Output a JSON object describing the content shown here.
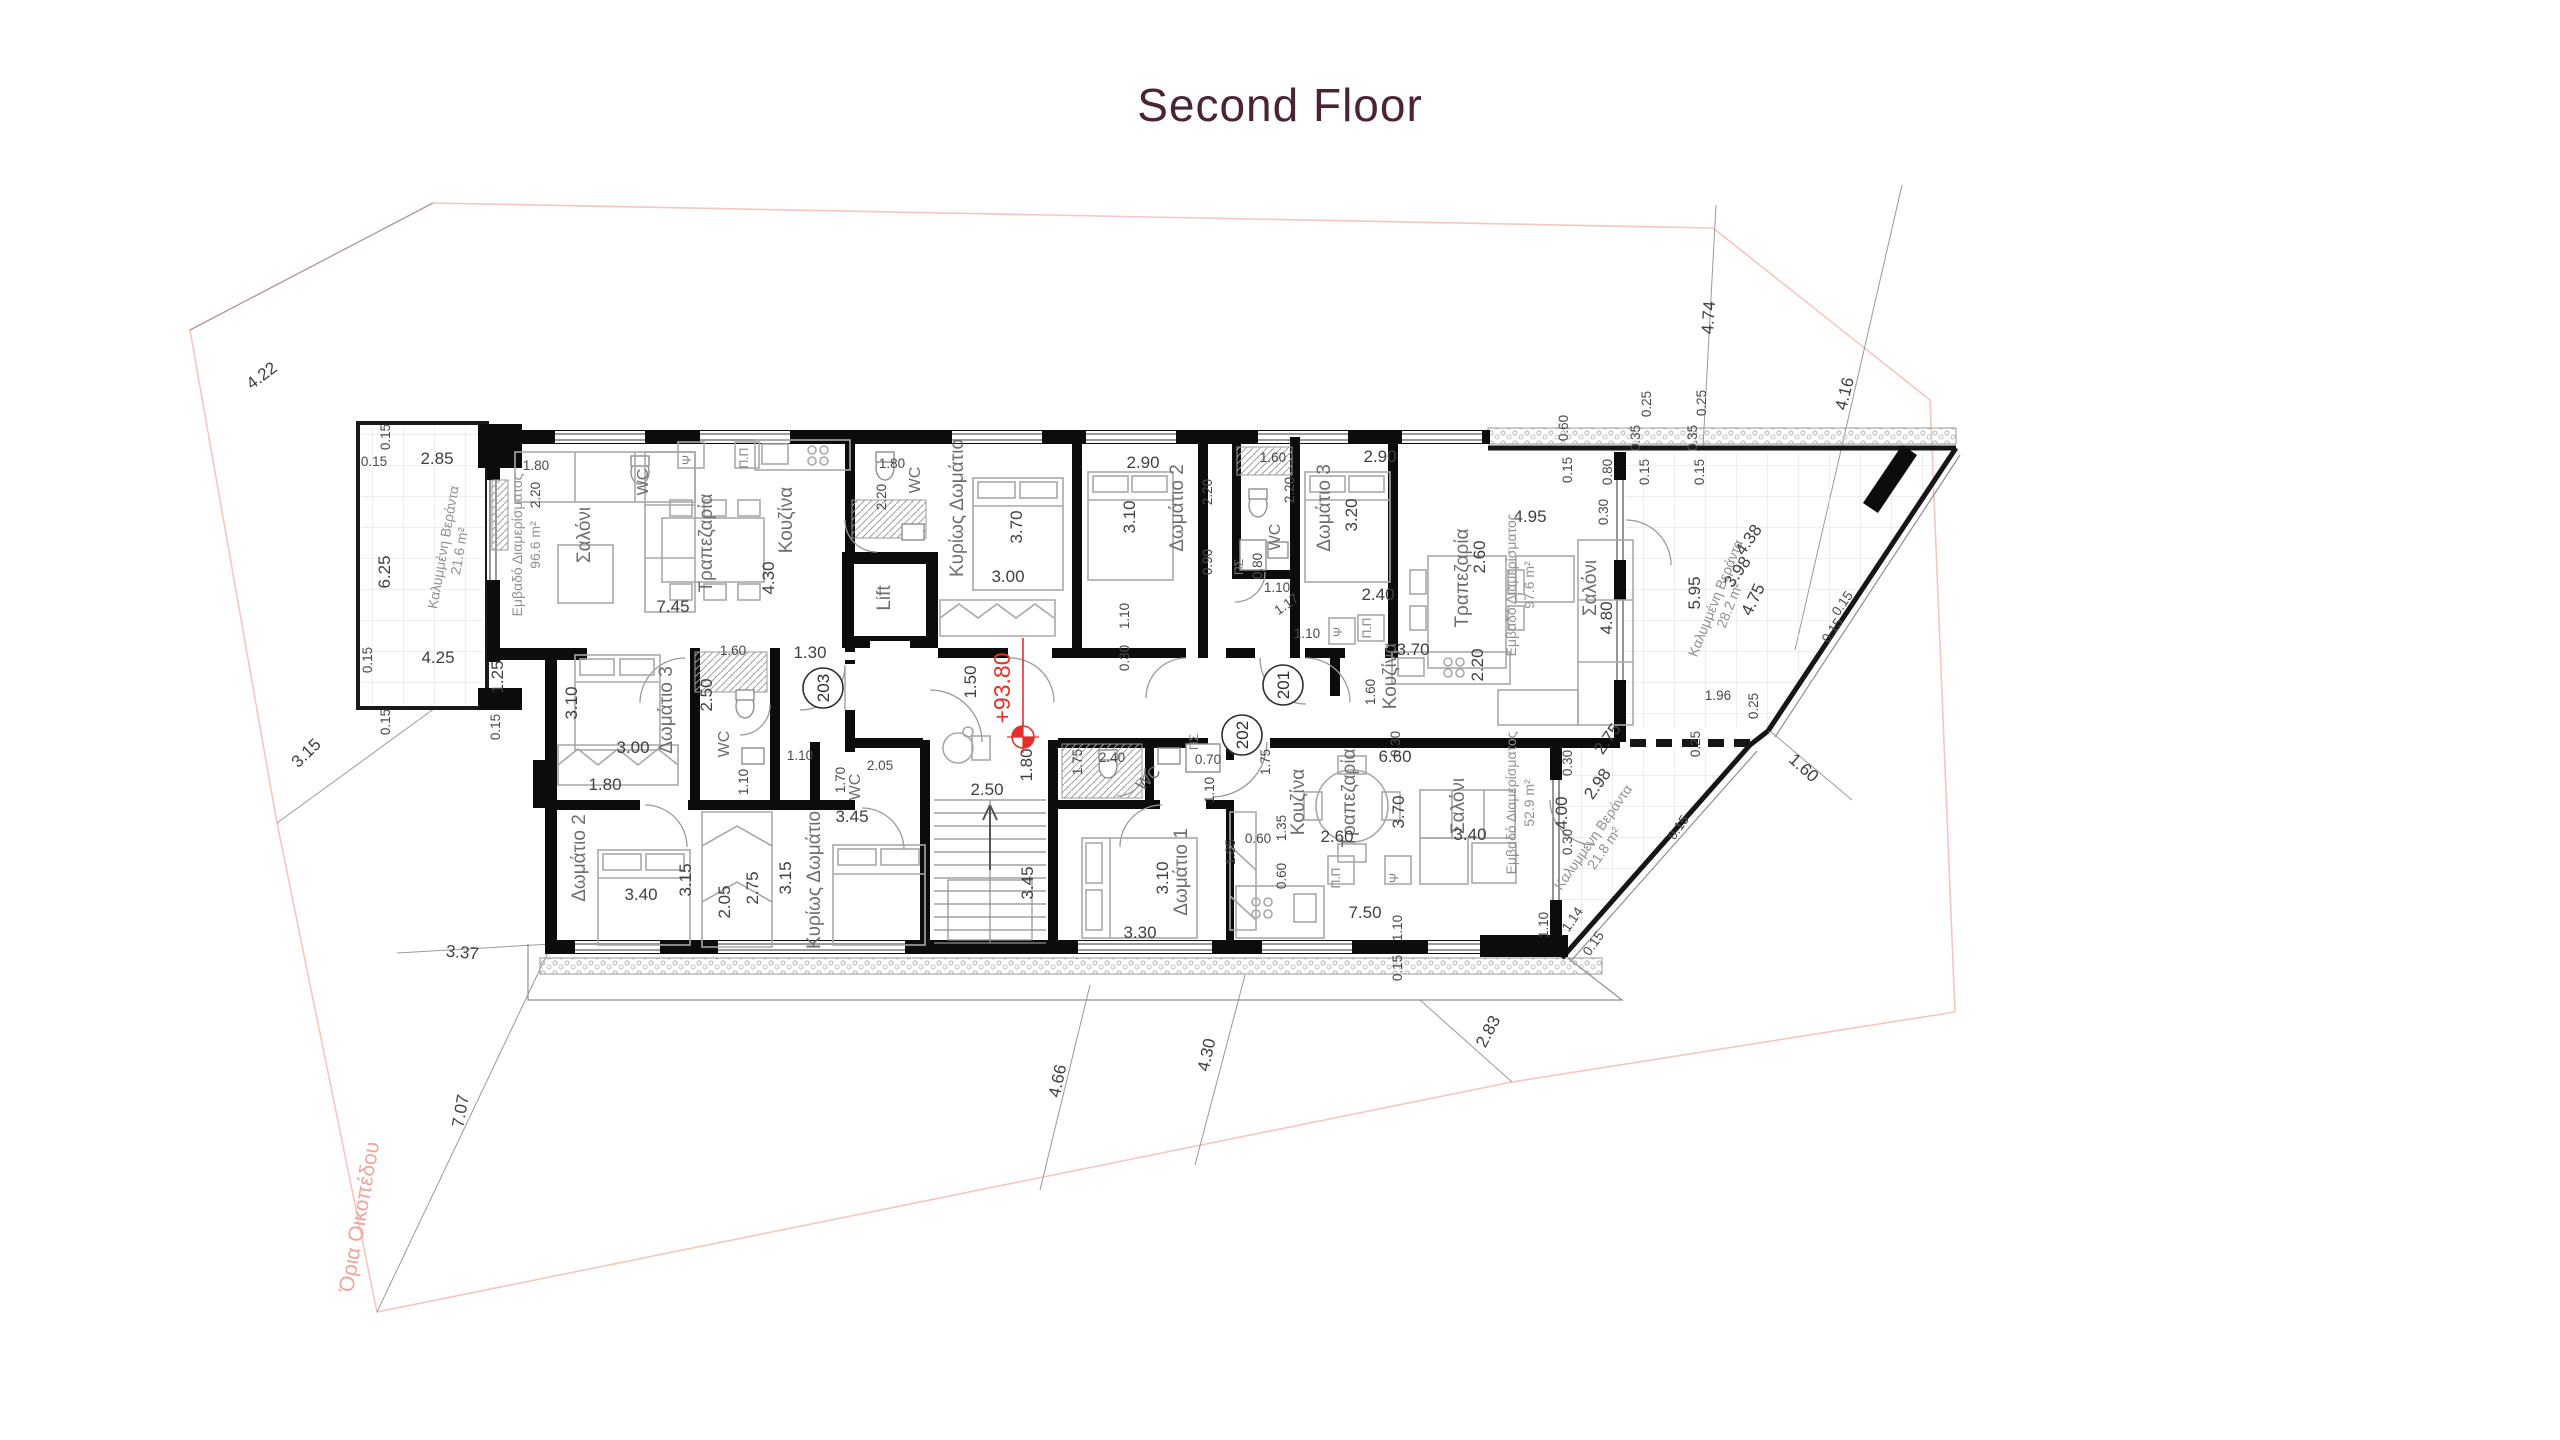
{
  "title": "Second Floor",
  "level_marker": {
    "text": "+93.80",
    "text_x": 1010,
    "text_y": 688,
    "line_x": 1023,
    "line_y1": 638,
    "line_y2": 737,
    "sym_x": 1023,
    "sym_y": 737
  },
  "entrances": [
    {
      "label": "203",
      "x": 823,
      "y": 688
    },
    {
      "label": "201",
      "x": 1283,
      "y": 685
    },
    {
      "label": "202",
      "x": 1242,
      "y": 735
    }
  ],
  "apartments": [
    {
      "unit": "201",
      "area": "97.6 m²",
      "veranda": "28.2 m²",
      "rooms": [
        "Κυρίως Δωμάτιο",
        "Δωμάτιο 2",
        "Δωμάτιο 3",
        "WC",
        "Κουζίνα",
        "Τραπεζαρία",
        "Σαλόνι"
      ]
    },
    {
      "unit": "202",
      "area": "52.9 m²",
      "veranda": "21.8 m²",
      "rooms": [
        "Δωμάτιο 1",
        "WC",
        "Κουζίνα",
        "Τραπεζαρία",
        "Σαλόνι"
      ]
    },
    {
      "unit": "203",
      "area": "96.6 m²",
      "veranda": "21.6 m²",
      "rooms": [
        "Σαλόνι",
        "Τραπεζαρία",
        "Κουζίνα",
        "Δωμάτιο 2",
        "Δωμάτιο 3",
        "Κυρίως Δωμάτιο",
        "WC"
      ]
    }
  ],
  "colors": {
    "title": "#4b2334",
    "red_level": "#e2312a",
    "boundary_pink": "#f6c6bf",
    "walls": "#0c0c0c",
    "dimension_text": "#3f3f3f",
    "room_text": "#6e6e6e"
  },
  "plan": {
    "boundary_label": "Όρια Οικοπέδου",
    "labels": [
      {
        "t": "4.22",
        "x": 265,
        "y": 380,
        "r": -37,
        "c": "d"
      },
      {
        "t": "3.15",
        "x": 310,
        "y": 757,
        "r": -44,
        "c": "d"
      },
      {
        "t": "3.37",
        "x": 462,
        "y": 958,
        "r": 5,
        "c": "d"
      },
      {
        "t": "7.07",
        "x": 466,
        "y": 1112,
        "r": -80,
        "c": "d"
      },
      {
        "t": "4.66",
        "x": 1063,
        "y": 1082,
        "r": -78,
        "c": "d"
      },
      {
        "t": "4.30",
        "x": 1212,
        "y": 1056,
        "r": -78,
        "c": "d"
      },
      {
        "t": "2.83",
        "x": 1493,
        "y": 1034,
        "r": -62,
        "c": "d"
      },
      {
        "t": "4.74",
        "x": 1714,
        "y": 318,
        "r": -86,
        "c": "d"
      },
      {
        "t": "4.16",
        "x": 1850,
        "y": 395,
        "r": -76,
        "c": "d"
      },
      {
        "t": "1.60",
        "x": 1800,
        "y": 772,
        "r": 42,
        "c": "d"
      },
      {
        "t": "Όρια Οικοπέδου",
        "x": 366,
        "y": 1218,
        "r": -80,
        "c": "pink",
        "n": "site-boundary-label"
      },
      {
        "t": "0.60",
        "x": 1568,
        "y": 428,
        "r": -90,
        "c": "ds"
      },
      {
        "t": "0.15",
        "x": 1572,
        "y": 470,
        "r": -90,
        "c": "ds"
      },
      {
        "t": "0.80",
        "x": 1612,
        "y": 472,
        "r": -90,
        "c": "ds"
      },
      {
        "t": "0.35",
        "x": 1640,
        "y": 438,
        "r": -90,
        "c": "ds"
      },
      {
        "t": "0.25",
        "x": 1651,
        "y": 404,
        "r": -90,
        "c": "ds"
      },
      {
        "t": "0.15",
        "x": 1649,
        "y": 472,
        "r": -90,
        "c": "ds"
      },
      {
        "t": "0.35",
        "x": 1697,
        "y": 438,
        "r": -90,
        "c": "ds"
      },
      {
        "t": "0.25",
        "x": 1706,
        "y": 403,
        "r": -90,
        "c": "ds"
      },
      {
        "t": "0.15",
        "x": 1704,
        "y": 472,
        "r": -90,
        "c": "ds"
      },
      {
        "t": "0.15",
        "x": 390,
        "y": 437,
        "r": -90,
        "c": "ds"
      },
      {
        "t": "2.85",
        "x": 437,
        "y": 464,
        "r": 0,
        "c": "d"
      },
      {
        "t": "0.15",
        "x": 374,
        "y": 466,
        "r": 0,
        "c": "ds"
      },
      {
        "t": "6.25",
        "x": 390,
        "y": 572,
        "r": -90,
        "c": "d"
      },
      {
        "t": "Καλυμμένη Βεράντα",
        "x": 448,
        "y": 548,
        "r": -80,
        "c": "a",
        "n": "veranda-label"
      },
      {
        "t": "21.6 m²",
        "x": 464,
        "y": 552,
        "r": -80,
        "c": "a"
      },
      {
        "t": "0.15",
        "x": 372,
        "y": 660,
        "r": -90,
        "c": "ds"
      },
      {
        "t": "4.25",
        "x": 438,
        "y": 663,
        "r": 0,
        "c": "d"
      },
      {
        "t": "1.25",
        "x": 503,
        "y": 677,
        "r": -90,
        "c": "d"
      },
      {
        "t": "0.15",
        "x": 390,
        "y": 722,
        "r": -90,
        "c": "ds"
      },
      {
        "t": "0.15",
        "x": 500,
        "y": 727,
        "r": -90,
        "c": "ds"
      },
      {
        "t": "Εμβαδό Διαμερίσματος",
        "x": 522,
        "y": 545,
        "r": -90,
        "c": "a",
        "n": "area-label-203"
      },
      {
        "t": "96.6 m²",
        "x": 540,
        "y": 545,
        "r": -90,
        "c": "a"
      },
      {
        "t": "Σαλόνι",
        "x": 590,
        "y": 535,
        "r": -90,
        "c": "r"
      },
      {
        "t": "Τραπεζαρία",
        "x": 712,
        "y": 543,
        "r": -90,
        "c": "r"
      },
      {
        "t": "Κουζίνα",
        "x": 792,
        "y": 520,
        "r": -90,
        "c": "r"
      },
      {
        "t": "4.30",
        "x": 774,
        "y": 578,
        "r": -90,
        "c": "d"
      },
      {
        "t": "7.45",
        "x": 673,
        "y": 612,
        "r": 0,
        "c": "d"
      },
      {
        "t": "Ψ",
        "x": 691,
        "y": 460,
        "r": -90,
        "c": "fx"
      },
      {
        "t": "Π.Π",
        "x": 748,
        "y": 458,
        "r": -90,
        "c": "fx"
      },
      {
        "t": "1.80",
        "x": 536,
        "y": 470,
        "r": 0,
        "c": "ds"
      },
      {
        "t": "2.20",
        "x": 540,
        "y": 495,
        "r": -90,
        "c": "ds"
      },
      {
        "t": "WC",
        "x": 648,
        "y": 482,
        "r": -90,
        "c": "rs"
      },
      {
        "t": "1.30",
        "x": 810,
        "y": 658,
        "r": 0,
        "c": "d"
      },
      {
        "t": "1.60",
        "x": 733,
        "y": 655,
        "r": 0,
        "c": "ds"
      },
      {
        "t": "2.50",
        "x": 712,
        "y": 695,
        "r": -90,
        "c": "d"
      },
      {
        "t": "WC",
        "x": 729,
        "y": 744,
        "r": -90,
        "c": "rs"
      },
      {
        "t": "Δωμάτιο 3",
        "x": 672,
        "y": 710,
        "r": -90,
        "c": "r"
      },
      {
        "t": "3.10",
        "x": 577,
        "y": 703,
        "r": -90,
        "c": "d"
      },
      {
        "t": "3.00",
        "x": 633,
        "y": 753,
        "r": 0,
        "c": "d"
      },
      {
        "t": "1.10",
        "x": 748,
        "y": 782,
        "r": -90,
        "c": "ds"
      },
      {
        "t": "1.10",
        "x": 800,
        "y": 760,
        "r": 0,
        "c": "ds"
      },
      {
        "t": "1.80",
        "x": 605,
        "y": 790,
        "r": 0,
        "c": "d"
      },
      {
        "t": "1.70",
        "x": 845,
        "y": 780,
        "r": -90,
        "c": "ds"
      },
      {
        "t": "WC",
        "x": 860,
        "y": 787,
        "r": -90,
        "c": "rs"
      },
      {
        "t": "2.05",
        "x": 880,
        "y": 770,
        "r": 0,
        "c": "ds"
      },
      {
        "t": "3.45",
        "x": 852,
        "y": 822,
        "r": 0,
        "c": "d"
      },
      {
        "t": "Δωμάτιο 2",
        "x": 585,
        "y": 858,
        "r": -90,
        "c": "r"
      },
      {
        "t": "3.40",
        "x": 641,
        "y": 900,
        "r": 0,
        "c": "d"
      },
      {
        "t": "3.15",
        "x": 691,
        "y": 880,
        "r": -90,
        "c": "d"
      },
      {
        "t": "2.05",
        "x": 730,
        "y": 902,
        "r": -90,
        "c": "d"
      },
      {
        "t": "2.75",
        "x": 758,
        "y": 888,
        "r": -90,
        "c": "d"
      },
      {
        "t": "3.15",
        "x": 791,
        "y": 878,
        "r": -90,
        "c": "d"
      },
      {
        "t": "Κυρίως Δωμάτιο",
        "x": 820,
        "y": 880,
        "r": -90,
        "c": "r"
      },
      {
        "t": "Lift",
        "x": 890,
        "y": 598,
        "r": -90,
        "c": "r",
        "n": "lift-label"
      },
      {
        "t": "WC",
        "x": 920,
        "y": 480,
        "r": -90,
        "c": "rs"
      },
      {
        "t": "2.20",
        "x": 886,
        "y": 497,
        "r": -90,
        "c": "ds"
      },
      {
        "t": "1.80",
        "x": 892,
        "y": 468,
        "r": 0,
        "c": "ds"
      },
      {
        "t": "1.50",
        "x": 976,
        "y": 682,
        "r": -90,
        "c": "d"
      },
      {
        "t": "2.50",
        "x": 987,
        "y": 795,
        "r": 0,
        "c": "d"
      },
      {
        "t": "1.80",
        "x": 1032,
        "y": 765,
        "r": -90,
        "c": "d"
      },
      {
        "t": "3.45",
        "x": 1033,
        "y": 883,
        "r": -90,
        "c": "d"
      },
      {
        "t": "Κυρίως Δωμάτιο",
        "x": 963,
        "y": 508,
        "r": -90,
        "c": "r"
      },
      {
        "t": "3.70",
        "x": 1022,
        "y": 527,
        "r": -90,
        "c": "d"
      },
      {
        "t": "3.00",
        "x": 1008,
        "y": 582,
        "r": 0,
        "c": "d"
      },
      {
        "t": "Δωμάτιο 2",
        "x": 1183,
        "y": 508,
        "r": -90,
        "c": "r"
      },
      {
        "t": "3.10",
        "x": 1135,
        "y": 517,
        "r": -90,
        "c": "d"
      },
      {
        "t": "2.90",
        "x": 1143,
        "y": 468,
        "r": 0,
        "c": "d"
      },
      {
        "t": "2.20",
        "x": 1212,
        "y": 492,
        "r": -90,
        "c": "ds"
      },
      {
        "t": "0.90",
        "x": 1212,
        "y": 562,
        "r": -90,
        "c": "ds"
      },
      {
        "t": "1.60",
        "x": 1273,
        "y": 462,
        "r": 0,
        "c": "ds"
      },
      {
        "t": "WC",
        "x": 1280,
        "y": 537,
        "r": -90,
        "c": "rs"
      },
      {
        "t": "0.80",
        "x": 1262,
        "y": 566,
        "r": -90,
        "c": "ds"
      },
      {
        "t": "ΠΣ",
        "x": 1243,
        "y": 567,
        "r": -90,
        "c": "fx"
      },
      {
        "t": "2.20",
        "x": 1294,
        "y": 490,
        "r": -90,
        "c": "ds"
      },
      {
        "t": "Δωμάτιο 3",
        "x": 1330,
        "y": 508,
        "r": -90,
        "c": "r"
      },
      {
        "t": "3.20",
        "x": 1357,
        "y": 515,
        "r": -90,
        "c": "d"
      },
      {
        "t": "2.90",
        "x": 1380,
        "y": 462,
        "r": 0,
        "c": "d"
      },
      {
        "t": "1.10",
        "x": 1277,
        "y": 592,
        "r": 0,
        "c": "ds"
      },
      {
        "t": "1.17",
        "x": 1289,
        "y": 608,
        "r": -35,
        "c": "ds"
      },
      {
        "t": "1.10",
        "x": 1307,
        "y": 638,
        "r": 0,
        "c": "ds"
      },
      {
        "t": "1.10",
        "x": 1129,
        "y": 616,
        "r": -90,
        "c": "ds"
      },
      {
        "t": "0.30",
        "x": 1129,
        "y": 658,
        "r": -90,
        "c": "ds"
      },
      {
        "t": "2.40",
        "x": 1378,
        "y": 600,
        "r": 0,
        "c": "d"
      },
      {
        "t": "3.70",
        "x": 1413,
        "y": 655,
        "r": 0,
        "c": "d"
      },
      {
        "t": "Κουζίνα",
        "x": 1396,
        "y": 676,
        "r": -90,
        "c": "r"
      },
      {
        "t": "1.60",
        "x": 1375,
        "y": 692,
        "r": -90,
        "c": "ds"
      },
      {
        "t": "2.20",
        "x": 1483,
        "y": 665,
        "r": -90,
        "c": "d"
      },
      {
        "t": "Τραπεζαρία",
        "x": 1468,
        "y": 578,
        "r": -90,
        "c": "r"
      },
      {
        "t": "2.60",
        "x": 1485,
        "y": 557,
        "r": -90,
        "c": "d"
      },
      {
        "t": "4.95",
        "x": 1530,
        "y": 522,
        "r": 0,
        "c": "d"
      },
      {
        "t": "Εμβαδό Διαμερίσματος",
        "x": 1516,
        "y": 585,
        "r": -90,
        "c": "a",
        "n": "area-label-201"
      },
      {
        "t": "97.6 m²",
        "x": 1534,
        "y": 585,
        "r": -90,
        "c": "a"
      },
      {
        "t": "Σαλόνι",
        "x": 1596,
        "y": 588,
        "r": -90,
        "c": "r"
      },
      {
        "t": "4.80",
        "x": 1612,
        "y": 618,
        "r": -90,
        "c": "d"
      },
      {
        "t": "Ψ",
        "x": 1342,
        "y": 632,
        "r": -90,
        "c": "fx"
      },
      {
        "t": "Π.Π",
        "x": 1371,
        "y": 628,
        "r": -90,
        "c": "fx"
      },
      {
        "t": "0.30",
        "x": 1608,
        "y": 512,
        "r": -90,
        "c": "ds"
      },
      {
        "t": "5.95",
        "x": 1700,
        "y": 593,
        "r": -90,
        "c": "d"
      },
      {
        "t": "Καλυμμένη Βεράντα",
        "x": 1720,
        "y": 600,
        "r": -68,
        "c": "a",
        "n": "veranda-label"
      },
      {
        "t": "28.2 m²",
        "x": 1734,
        "y": 607,
        "r": -68,
        "c": "a"
      },
      {
        "t": "4.75",
        "x": 1758,
        "y": 602,
        "r": -64,
        "c": "d"
      },
      {
        "t": "4.38",
        "x": 1753,
        "y": 543,
        "r": -55,
        "c": "d"
      },
      {
        "t": "3.98",
        "x": 1742,
        "y": 575,
        "r": -55,
        "c": "d"
      },
      {
        "t": "1.96",
        "x": 1718,
        "y": 700,
        "r": 0,
        "c": "ds"
      },
      {
        "t": "0.25",
        "x": 1758,
        "y": 706,
        "r": -90,
        "c": "ds"
      },
      {
        "t": "0.25",
        "x": 1700,
        "y": 744,
        "r": -90,
        "c": "ds"
      },
      {
        "t": "0.15",
        "x": 1846,
        "y": 606,
        "r": -55,
        "c": "ds"
      },
      {
        "t": "0.15",
        "x": 1836,
        "y": 633,
        "r": -55,
        "c": "ds"
      },
      {
        "t": "0.15",
        "x": 1682,
        "y": 830,
        "r": -55,
        "c": "ds"
      },
      {
        "t": "1.75",
        "x": 1082,
        "y": 762,
        "r": -90,
        "c": "ds"
      },
      {
        "t": "2.40",
        "x": 1112,
        "y": 762,
        "r": 0,
        "c": "ds"
      },
      {
        "t": "WC",
        "x": 1152,
        "y": 782,
        "r": -45,
        "c": "rs"
      },
      {
        "t": "0.70",
        "x": 1208,
        "y": 764,
        "r": 0,
        "c": "ds"
      },
      {
        "t": "1.10",
        "x": 1214,
        "y": 790,
        "r": -90,
        "c": "ds"
      },
      {
        "t": "ΠΣ",
        "x": 1198,
        "y": 742,
        "r": -90,
        "c": "fx"
      },
      {
        "t": "1.75",
        "x": 1270,
        "y": 762,
        "r": -90,
        "c": "ds"
      },
      {
        "t": "Δωμάτιο 1",
        "x": 1187,
        "y": 872,
        "r": -90,
        "c": "r"
      },
      {
        "t": "3.10",
        "x": 1168,
        "y": 878,
        "r": -90,
        "c": "d"
      },
      {
        "t": "3.30",
        "x": 1140,
        "y": 938,
        "r": 0,
        "c": "d"
      },
      {
        "t": "1.85",
        "x": 1235,
        "y": 852,
        "r": -90,
        "c": "ds"
      },
      {
        "t": "0.60",
        "x": 1258,
        "y": 843,
        "r": 0,
        "c": "ds"
      },
      {
        "t": "Κουζίνα",
        "x": 1304,
        "y": 802,
        "r": -90,
        "c": "r"
      },
      {
        "t": "1.35",
        "x": 1286,
        "y": 828,
        "r": -90,
        "c": "ds"
      },
      {
        "t": "0.60",
        "x": 1286,
        "y": 876,
        "r": -90,
        "c": "ds"
      },
      {
        "t": "Τραπεζαρία",
        "x": 1355,
        "y": 798,
        "r": -90,
        "c": "r"
      },
      {
        "t": "2.60",
        "x": 1337,
        "y": 842,
        "r": 0,
        "c": "d"
      },
      {
        "t": "6.60",
        "x": 1395,
        "y": 762,
        "r": 0,
        "c": "d"
      },
      {
        "t": "3.70",
        "x": 1404,
        "y": 812,
        "r": -90,
        "c": "d"
      },
      {
        "t": "0.30",
        "x": 1400,
        "y": 744,
        "r": -90,
        "c": "ds"
      },
      {
        "t": "Σαλόνι",
        "x": 1464,
        "y": 806,
        "r": -90,
        "c": "r"
      },
      {
        "t": "3.40",
        "x": 1470,
        "y": 840,
        "r": 0,
        "c": "d"
      },
      {
        "t": "Εμβαδό Διαμερίσματος",
        "x": 1516,
        "y": 803,
        "r": -90,
        "c": "a",
        "n": "area-label-202"
      },
      {
        "t": "52.9 m²",
        "x": 1534,
        "y": 803,
        "r": -90,
        "c": "a"
      },
      {
        "t": "4.00",
        "x": 1567,
        "y": 813,
        "r": -90,
        "c": "d"
      },
      {
        "t": "0.30",
        "x": 1572,
        "y": 763,
        "r": -90,
        "c": "ds"
      },
      {
        "t": "0.30",
        "x": 1572,
        "y": 842,
        "r": -90,
        "c": "ds"
      },
      {
        "t": "2.98",
        "x": 1602,
        "y": 787,
        "r": -55,
        "c": "d"
      },
      {
        "t": "Καλυμμένη Βεράντα",
        "x": 1597,
        "y": 840,
        "r": -55,
        "c": "a",
        "n": "veranda-label"
      },
      {
        "t": "21.8 m²",
        "x": 1608,
        "y": 851,
        "r": -55,
        "c": "a"
      },
      {
        "t": "2.75",
        "x": 1612,
        "y": 742,
        "r": -55,
        "c": "d"
      },
      {
        "t": "7.50",
        "x": 1365,
        "y": 918,
        "r": 0,
        "c": "d"
      },
      {
        "t": "1.10",
        "x": 1402,
        "y": 928,
        "r": -90,
        "c": "ds"
      },
      {
        "t": "1.10",
        "x": 1548,
        "y": 925,
        "r": -90,
        "c": "ds"
      },
      {
        "t": "1.14",
        "x": 1576,
        "y": 922,
        "r": -55,
        "c": "ds"
      },
      {
        "t": "0.15",
        "x": 1597,
        "y": 946,
        "r": -55,
        "c": "ds"
      },
      {
        "t": "0.15",
        "x": 1402,
        "y": 968,
        "r": -90,
        "c": "ds"
      },
      {
        "t": "Π.Π",
        "x": 1340,
        "y": 878,
        "r": -90,
        "c": "fx"
      },
      {
        "t": "Ψ",
        "x": 1398,
        "y": 878,
        "r": -90,
        "c": "fx"
      }
    ]
  }
}
